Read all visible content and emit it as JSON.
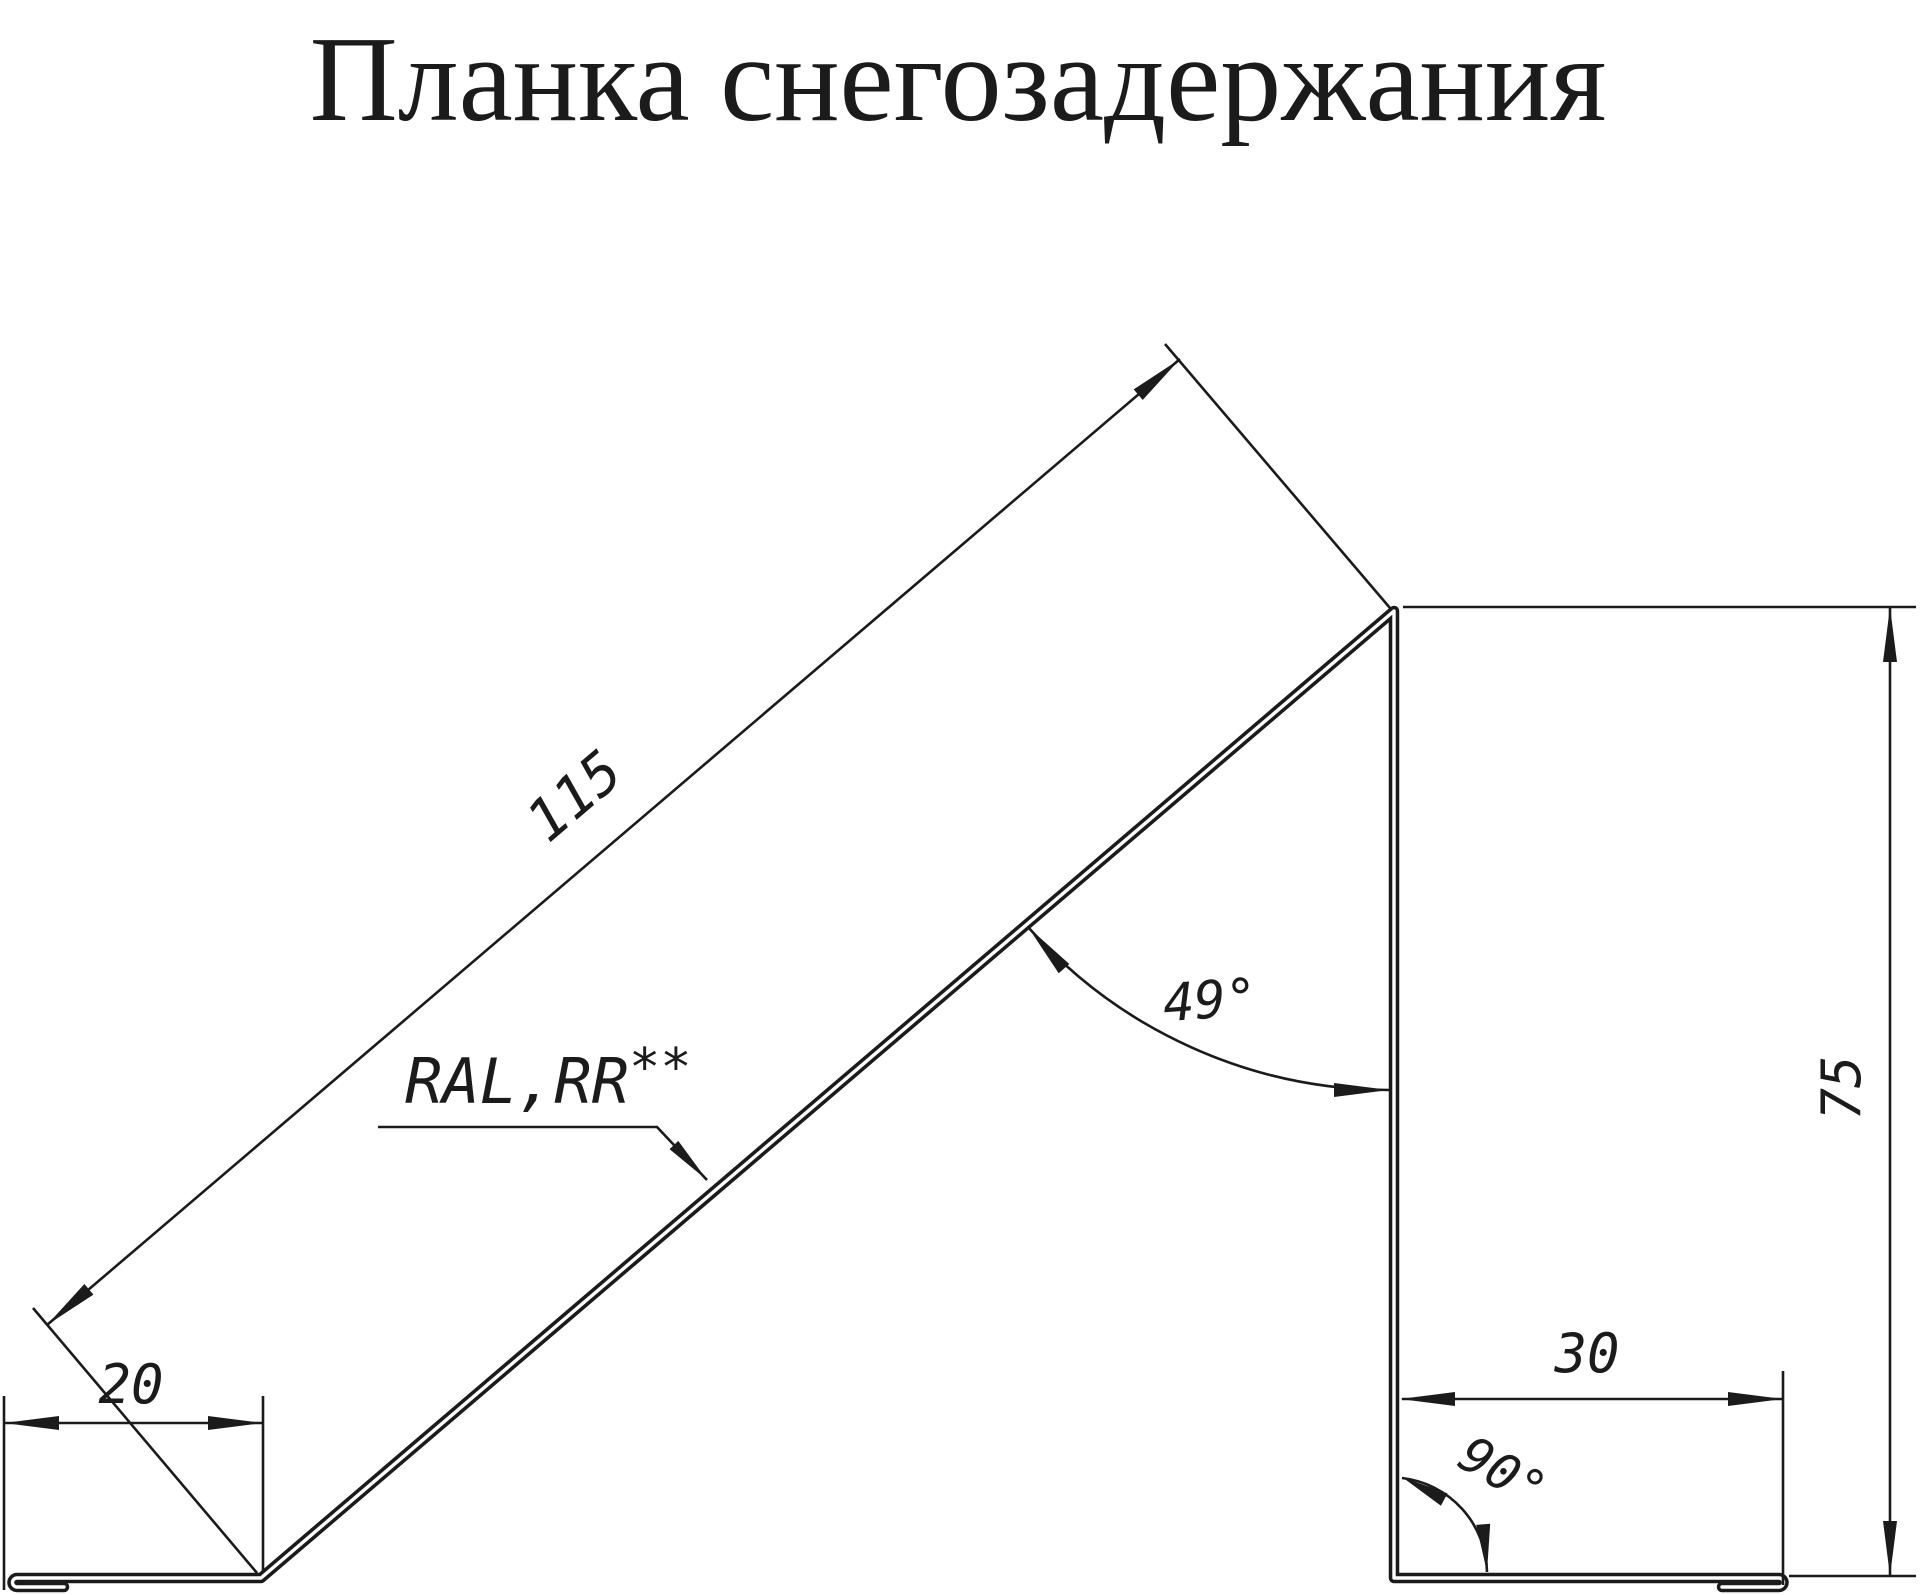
{
  "title": "Планка снегозадержания",
  "colors": {
    "ink": "#1b1b1b",
    "background": "#ffffff"
  },
  "dimensions": {
    "slope_length": "115",
    "left_flange": "20",
    "height": "75",
    "bottom_flange": "30",
    "bend_angle": "49°",
    "right_angle": "90°"
  },
  "material": {
    "text": "RAL,RR",
    "sup": "**"
  }
}
